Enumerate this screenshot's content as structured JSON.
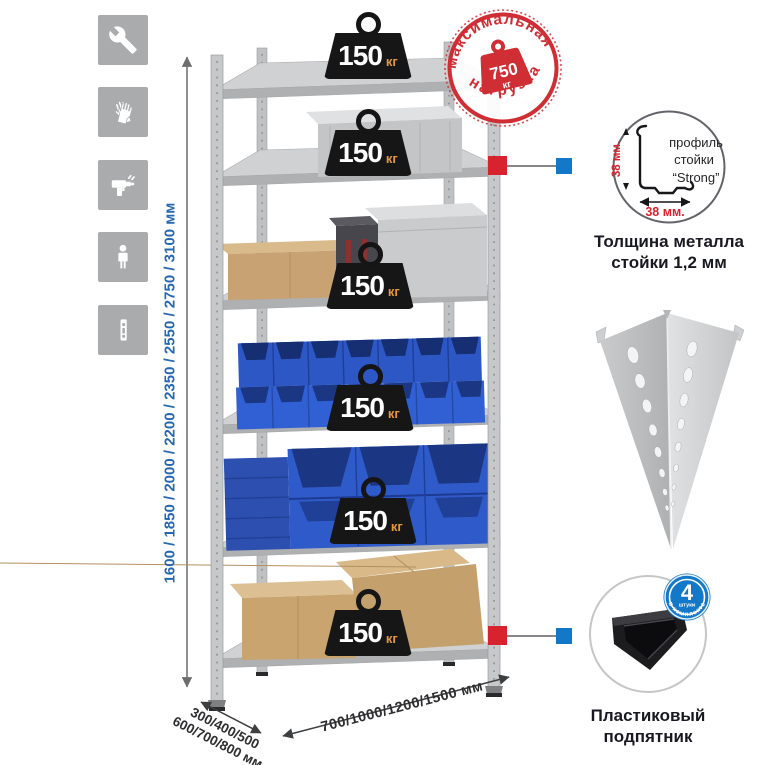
{
  "colors": {
    "accent_red": "#d6232e",
    "accent_blue": "#1478c8",
    "stamp_red": "#cf2e35",
    "dimension_blue": "#2668b0",
    "icon_bg": "#a9abad",
    "bin_blue": "#2f5bca",
    "cardboard": "#c9a46f",
    "weight_black": "#161616"
  },
  "left_toolbar": {
    "icons": [
      {
        "name": "wrench-icon"
      },
      {
        "name": "gloves-icon"
      },
      {
        "name": "drill-icon"
      },
      {
        "name": "person-icon"
      },
      {
        "name": "rack-post-icon"
      }
    ]
  },
  "height_dimension": {
    "label": "1600 / 1850 / 2000 / 2200 / 2350 / 2550 / 2750 / 3100 мм"
  },
  "shelf_weight": {
    "value": "150",
    "unit": "кг"
  },
  "max_load_stamp": {
    "arc_top": "максимальная",
    "arc_bottom": "нагрузка",
    "value": "750",
    "unit": "кг"
  },
  "profile_detail": {
    "label_line1": "профиль",
    "label_line2": "стойки",
    "label_line3": "“Strong”",
    "vertical_dim": "38 мм.",
    "horizontal_dim": "38 мм.",
    "caption_line1": "Толщина металла",
    "caption_line2": "стойки 1,2 мм"
  },
  "foot_detail": {
    "badge_value": "4",
    "badge_unit": "штуки",
    "badge_arc": "в комплекте",
    "caption_line1": "Пластиковый",
    "caption_line2": "подпятник"
  },
  "bottom_dimensions": {
    "depth_line1": "300/400/500",
    "depth_line2": "600/700/800 мм",
    "width_label": "700/1000/1200/1500 мм"
  }
}
